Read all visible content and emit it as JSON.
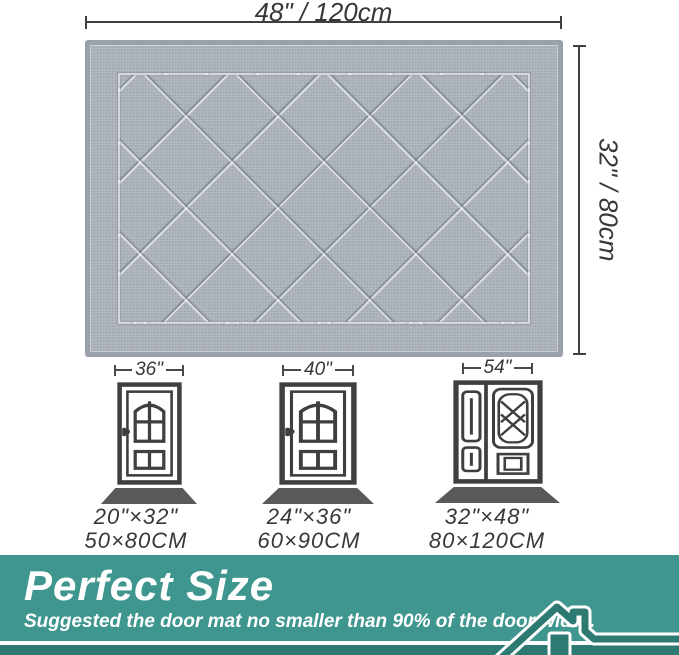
{
  "mat_dimensions": {
    "width_label": "48\" / 120cm",
    "height_label": "32\" / 80cm"
  },
  "doors": [
    {
      "type": "single",
      "width_label": "36\"",
      "size_in": "20\"×32\"",
      "size_cm": "50×80CM"
    },
    {
      "type": "single",
      "width_label": "40\"",
      "size_in": "24\"×36\"",
      "size_cm": "60×90CM"
    },
    {
      "type": "double",
      "width_label": "54\"",
      "size_in": "32\"×48\"",
      "size_cm": "80×120CM"
    }
  ],
  "banner": {
    "title": "Perfect Size",
    "subtitle": "Suggested the door mat no smaller than 90% of the door width.",
    "icon": "house-icon"
  },
  "colors": {
    "banner_background": "#3f968e",
    "banner_dark_accent": "#2c7a72",
    "banner_text": "#ffffff",
    "mat_base": "#adb3bb",
    "mat_edge": "#9aa1aa",
    "line_art": "#3f3f3f",
    "door_mat_shadow": "#595959",
    "dimension_text": "#383838"
  }
}
